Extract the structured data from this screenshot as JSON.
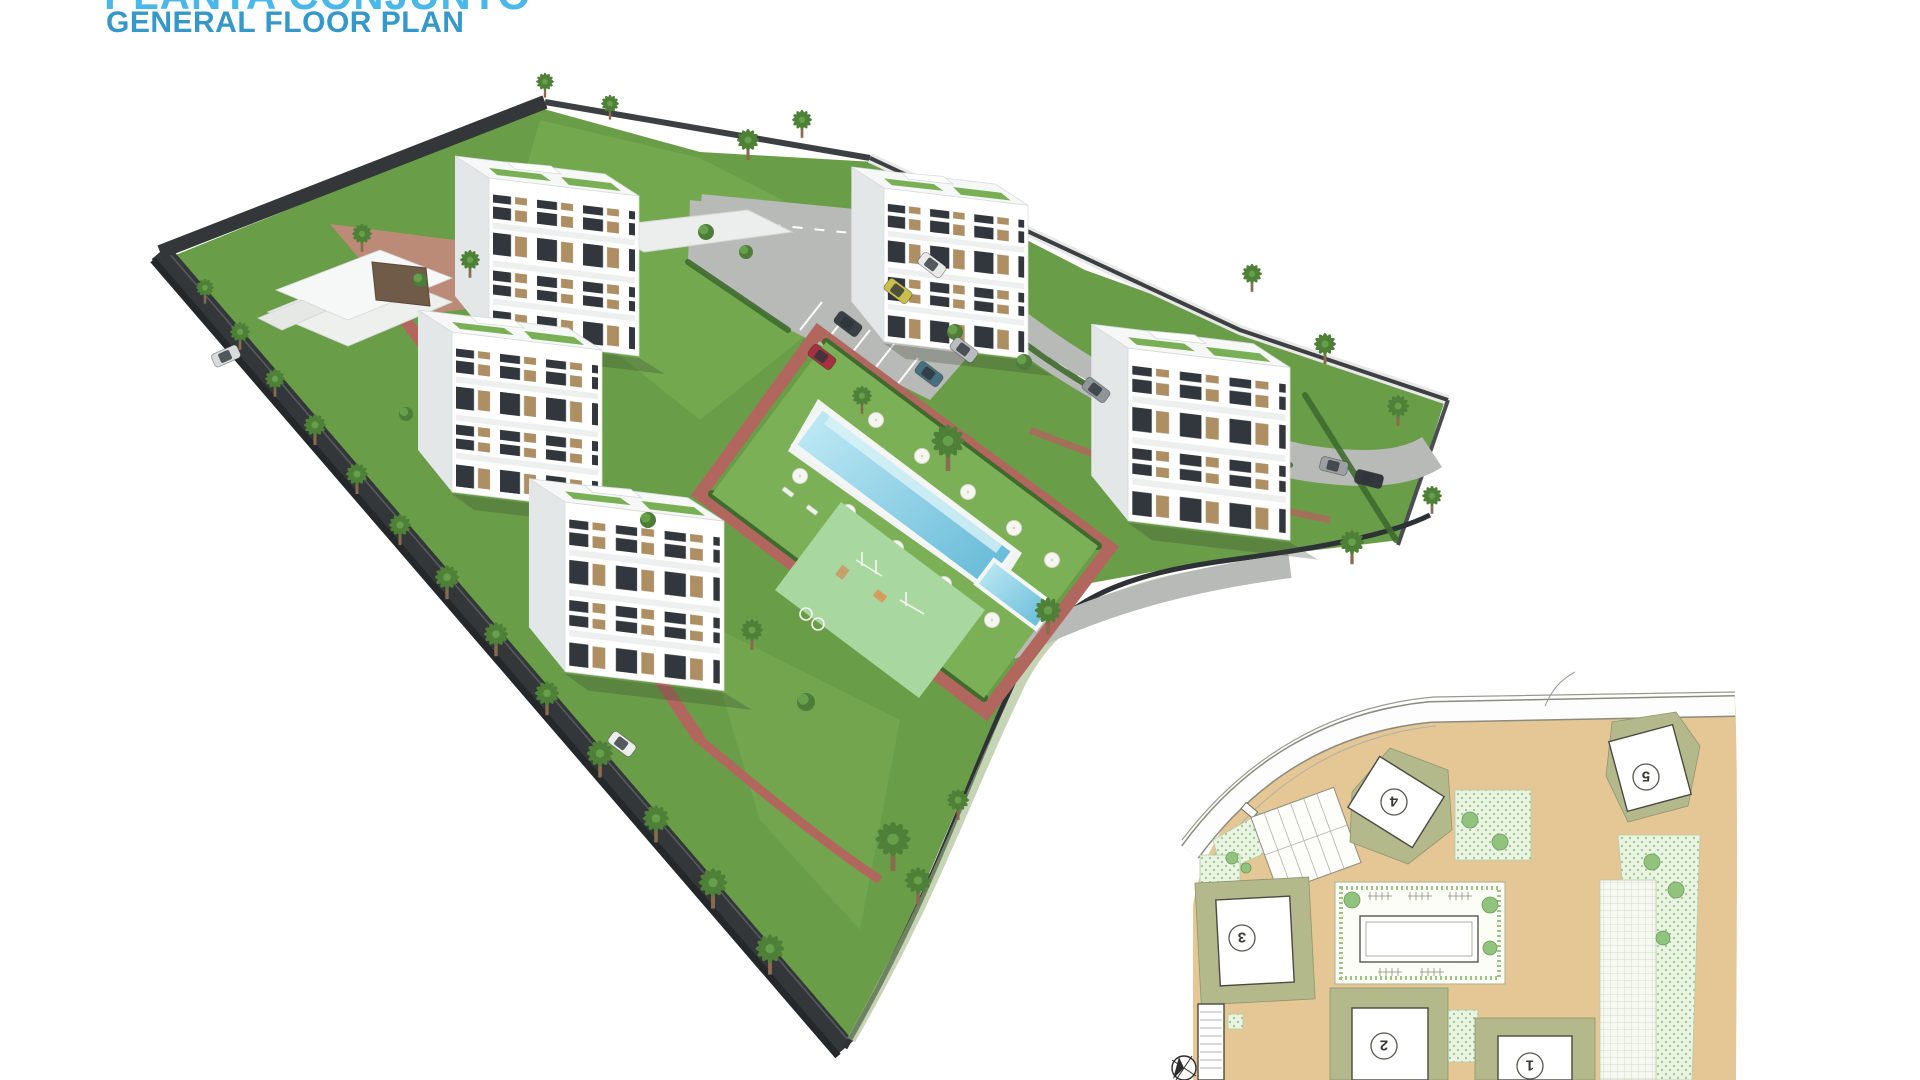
{
  "header": {
    "title_line1": "PLANTA CONJUNTO",
    "title_line2": "GENERAL FLOOR PLAN"
  },
  "colors": {
    "accent": "#3598c8",
    "accent_light": "#49b8e8",
    "grass": "#6a9d47",
    "grass_light": "#7cb056",
    "road_dark": "#33373a",
    "road_light": "#b7bab6",
    "brick": "#b2675e",
    "brick_light": "#c5897d",
    "pool": "#9adcef",
    "pool_deep": "#5fb7d6",
    "building_front": "#ffffff",
    "building_side": "#e3e7e8",
    "roof": "#f6f8f7",
    "roof_garden": "#7ab055",
    "hedge": "#3f6b2e",
    "playground": "#a8d8a0",
    "plan_tan": "#e4c795",
    "plan_olive": "#b3b98a",
    "plan_hatch": "#d8ebcf",
    "plan_tree": "#90c47d",
    "footprint_line": "#4a4a42"
  },
  "render_3d": {
    "building_count": 5,
    "features": [
      "apartment-block",
      "communal-pool",
      "kids-pool",
      "playground",
      "clubhouse",
      "carport",
      "parking",
      "palm-trees",
      "lawn",
      "perimeter-road",
      "brick-paths"
    ]
  },
  "cars": [
    {
      "x": 822,
      "y": 357,
      "rot": 37,
      "color": "#a63040"
    },
    {
      "x": 848,
      "y": 324,
      "rot": 37,
      "color": "#3a4045"
    },
    {
      "x": 898,
      "y": 291,
      "rot": 37,
      "color": "#c9bd4e"
    },
    {
      "x": 932,
      "y": 265,
      "rot": 37,
      "color": "#e9ebea"
    },
    {
      "x": 929,
      "y": 374,
      "rot": 37,
      "color": "#45707f"
    },
    {
      "x": 964,
      "y": 350,
      "rot": 37,
      "color": "#b9bdbf"
    },
    {
      "x": 1334,
      "y": 466,
      "rot": 14,
      "color": "#9aa0a3"
    },
    {
      "x": 1369,
      "y": 479,
      "rot": 14,
      "color": "#32383c"
    },
    {
      "x": 622,
      "y": 744,
      "rot": 37,
      "color": "#eceeed"
    },
    {
      "x": 226,
      "y": 356,
      "rot": -24,
      "color": "#d9dbdb"
    },
    {
      "x": 1096,
      "y": 390,
      "rot": 37,
      "color": "#8f969a"
    }
  ],
  "site_plan": {
    "building_labels": [
      {
        "label": "1",
        "x": 1530,
        "y": 1066
      },
      {
        "label": "2",
        "x": 1384,
        "y": 1046
      },
      {
        "label": "3",
        "x": 1242,
        "y": 938
      },
      {
        "label": "4",
        "x": 1394,
        "y": 802
      },
      {
        "label": "5",
        "x": 1646,
        "y": 777
      }
    ],
    "labels_rotated_deg": 180,
    "compass": "north-arrow"
  }
}
